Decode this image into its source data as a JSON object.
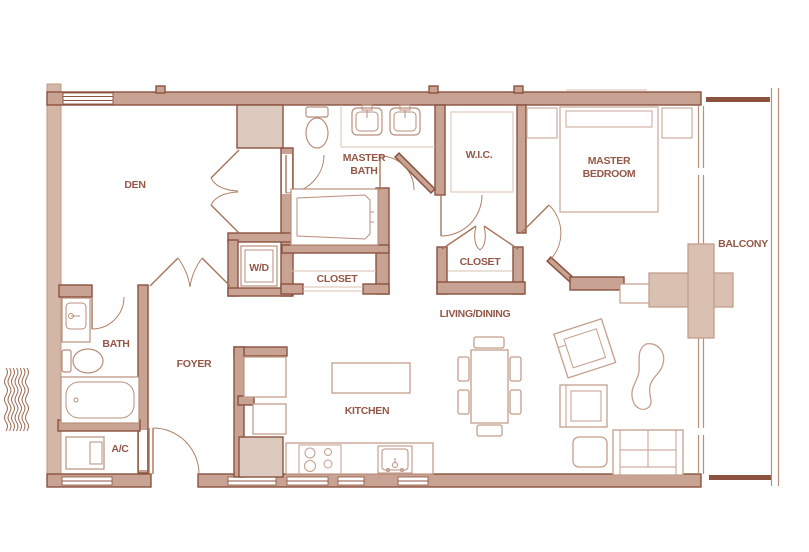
{
  "rooms": {
    "den": "DEN",
    "master_bath_line1": "MASTER",
    "master_bath_line2": "BATH",
    "wic": "W.I.C.",
    "master_bedroom_line1": "MASTER",
    "master_bedroom_line2": "BEDROOM",
    "balcony": "BALCONY",
    "washer_dryer": "W/D",
    "closet_hall": "CLOSET",
    "closet_bedroom": "CLOSET",
    "living_dining": "LIVING/DINING",
    "bath": "BATH",
    "foyer": "FOYER",
    "kitchen": "KITCHEN",
    "ac": "A/C"
  },
  "colors": {
    "wall_fill": "#c8a393",
    "wall_outline": "#8c5240",
    "exterior_wall_fill": "#d4b6a6",
    "column_fill": "#ddcabf",
    "structure_fill": "#d9c0b1",
    "furniture_line": "#c49e8c",
    "fixture_line": "#b98f7c",
    "door_line": "#b08066",
    "label_text": "#935847",
    "background": "#ffffff"
  }
}
